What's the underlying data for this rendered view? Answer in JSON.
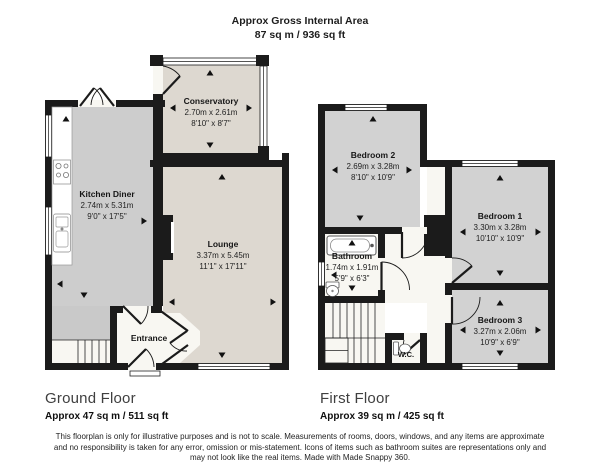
{
  "header": {
    "title": "Approx Gross Internal Area",
    "area": "87 sq m / 936 sq ft"
  },
  "ground_floor": {
    "title": "Ground Floor",
    "area": "Approx 47 sq m / 511 sq ft",
    "rooms": {
      "conservatory": {
        "name": "Conservatory",
        "metric": "2.70m x 2.61m",
        "imperial": "8'10\" x 8'7\""
      },
      "kitchen_diner": {
        "name": "Kitchen Diner",
        "metric": "2.74m x 5.31m",
        "imperial": "9'0\" x 17'5\""
      },
      "lounge": {
        "name": "Lounge",
        "metric": "3.37m x 5.45m",
        "imperial": "11'1\" x 17'11\""
      },
      "entrance": {
        "name": "Entrance"
      }
    }
  },
  "first_floor": {
    "title": "First Floor",
    "area": "Approx 39 sq m / 425 sq ft",
    "rooms": {
      "bedroom2": {
        "name": "Bedroom 2",
        "metric": "2.69m x 3.28m",
        "imperial": "8'10\" x 10'9\""
      },
      "bedroom1": {
        "name": "Bedroom 1",
        "metric": "3.30m x 3.28m",
        "imperial": "10'10\" x 10'9\""
      },
      "bathroom": {
        "name": "Bathroom",
        "metric": "1.74m x 1.91m",
        "imperial": "5'9\" x 6'3\""
      },
      "bedroom3": {
        "name": "Bedroom 3",
        "metric": "3.27m x 2.06m",
        "imperial": "10'9\" x 6'9\""
      },
      "wc": {
        "name": "W.C."
      }
    }
  },
  "disclaimer": {
    "line1": "This floorplan is only for illustrative purposes and is not to scale. Measurements of rooms, doors, windows, and any items are approximate",
    "line2": "and no responsibility is taken for any error, omission or mis-statement. Icons of items such as bathroom suites are representations only and",
    "line3": "may not look like the real items. Made with Made Snappy 360."
  },
  "colors": {
    "wall": "#1b1b1b",
    "room_beige": "#ddd8d0",
    "room_gray": "#cdcdcd",
    "room_white": "#f8f7f2",
    "vestibule_gray": "#c9c9c9"
  }
}
